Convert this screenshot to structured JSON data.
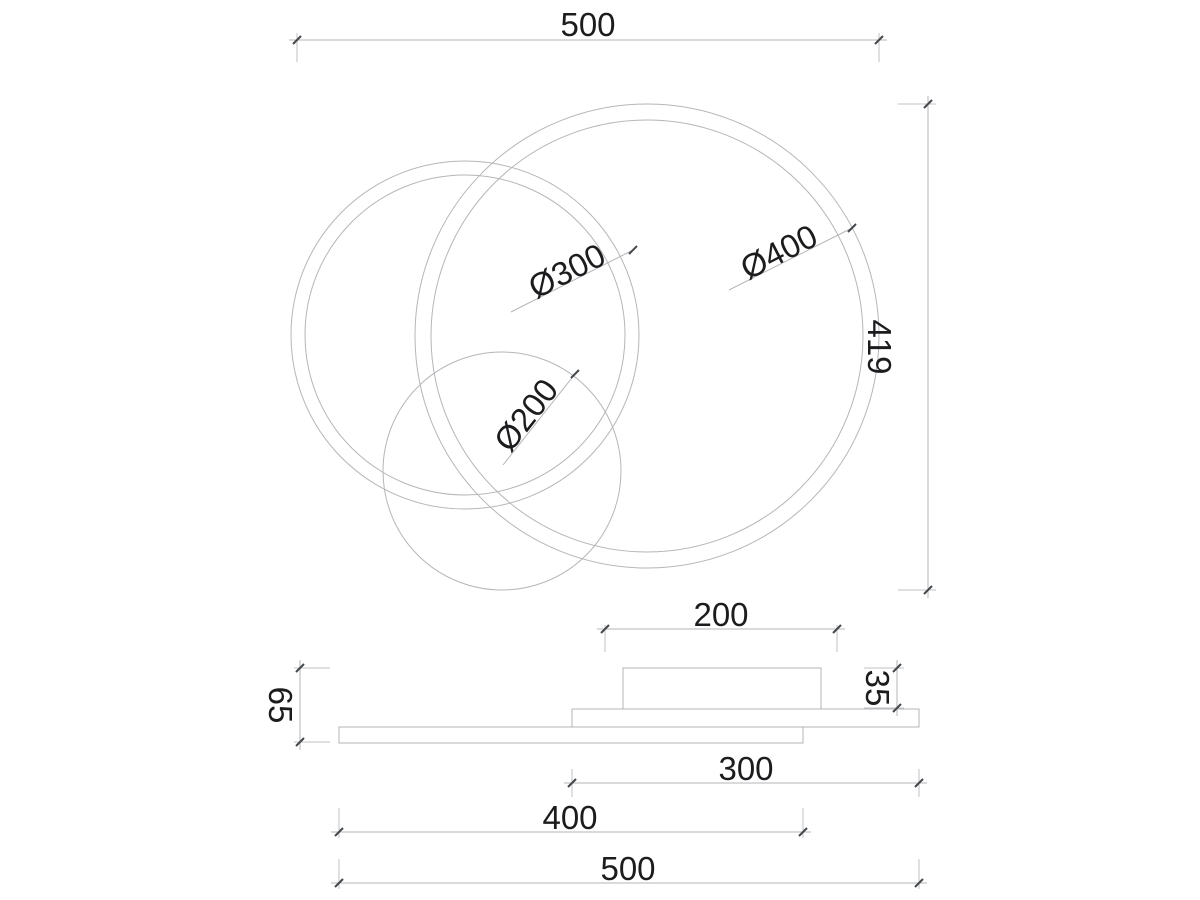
{
  "title": "Ceiling light fixture dimension drawing",
  "top_view": {
    "overall_width": "500",
    "overall_height": "419",
    "ring_large_diameter": "Ø400",
    "ring_medium_diameter": "Ø300",
    "ring_small_diameter": "Ø200"
  },
  "side_view": {
    "canopy_width": "200",
    "canopy_height": "35",
    "total_height": "65",
    "inner_plate_width": "300",
    "base_plate_width": "400",
    "overall_width": "500"
  },
  "colors": {
    "background": "#ffffff",
    "line_color": "#b4b6b9",
    "extension_line_color": "#c0c2c5",
    "tick_color": "#45484c",
    "text_color": "#1c1c1e"
  }
}
